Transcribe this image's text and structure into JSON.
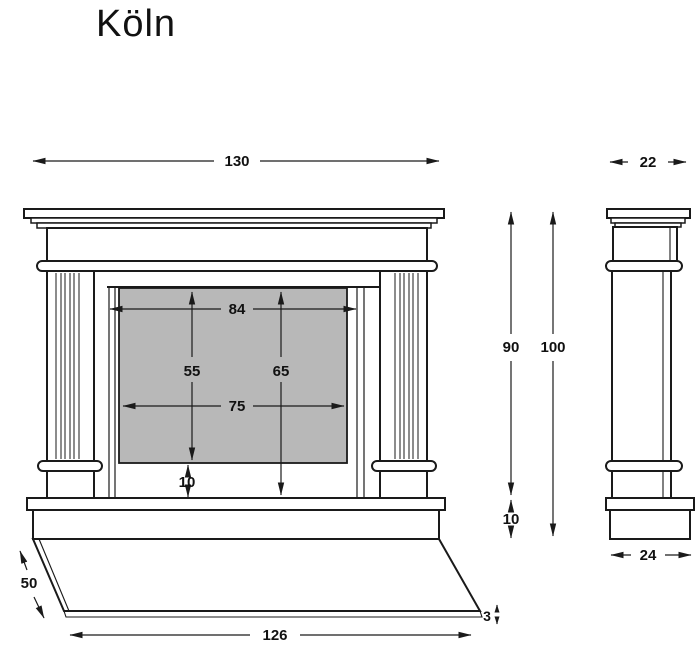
{
  "title": "Köln",
  "colors": {
    "line": "#1a1a1a",
    "panel_fill": "#b8b8b8",
    "background": "#ffffff",
    "text": "#111111"
  },
  "diagram_type": "fireplace-surround dimensioned technical drawing, front and side elevation",
  "views": {
    "front": {
      "name": "front-elevation",
      "dimensions": [
        {
          "id": "overall_width",
          "value": "130"
        },
        {
          "id": "opening_width",
          "value": "84"
        },
        {
          "id": "panel_width",
          "value": "75"
        },
        {
          "id": "panel_height",
          "value": "55"
        },
        {
          "id": "opening_height",
          "value": "65"
        },
        {
          "id": "panel_to_base_gap",
          "value": "10"
        },
        {
          "id": "hearth_plate_width",
          "value": "126"
        },
        {
          "id": "hearth_plate_depth",
          "value": "50"
        },
        {
          "id": "hearth_plate_thickness",
          "value": "3"
        }
      ]
    },
    "side": {
      "name": "side-elevation",
      "dimensions": [
        {
          "id": "shelf_depth",
          "value": "22"
        },
        {
          "id": "height_above_base",
          "value": "90"
        },
        {
          "id": "overall_height",
          "value": "100"
        },
        {
          "id": "base_height",
          "value": "10"
        },
        {
          "id": "base_depth",
          "value": "24"
        }
      ]
    }
  }
}
